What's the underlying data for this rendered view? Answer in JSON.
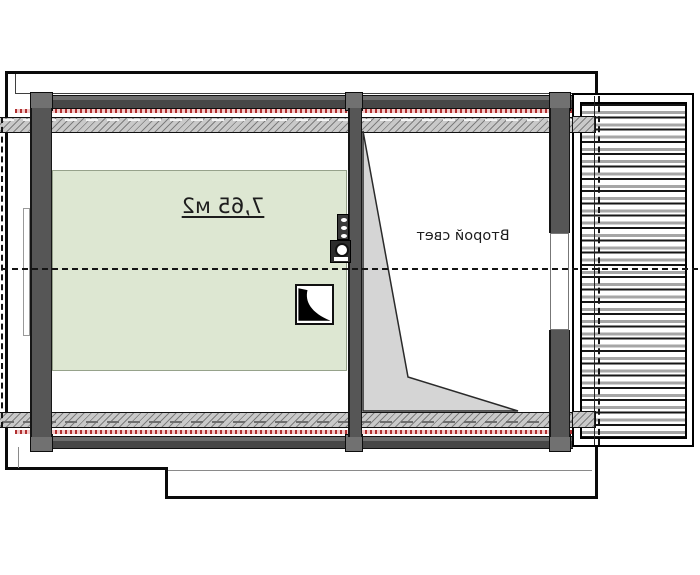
{
  "labels": {
    "room_area": "7,65 м2",
    "void": "Второй свет"
  },
  "colors": {
    "outline": "#0a0a0a",
    "wall": "#565656",
    "post": "#717171",
    "hatch-base": "#c9c9c9",
    "hatch-line": "#7d7d7d",
    "green-room": "#dde7d2",
    "void-triangle": "#d5d5d5",
    "red-base": "#f3caca",
    "red-dash": "#b03030"
  },
  "symbols": {
    "chimney": "chimney-flue-icon",
    "vent": "vent-stack-icon",
    "skylight": "roof-hatch-icon",
    "deck": "decking-planks",
    "centerline": "roof-ridge-dashed-line"
  }
}
